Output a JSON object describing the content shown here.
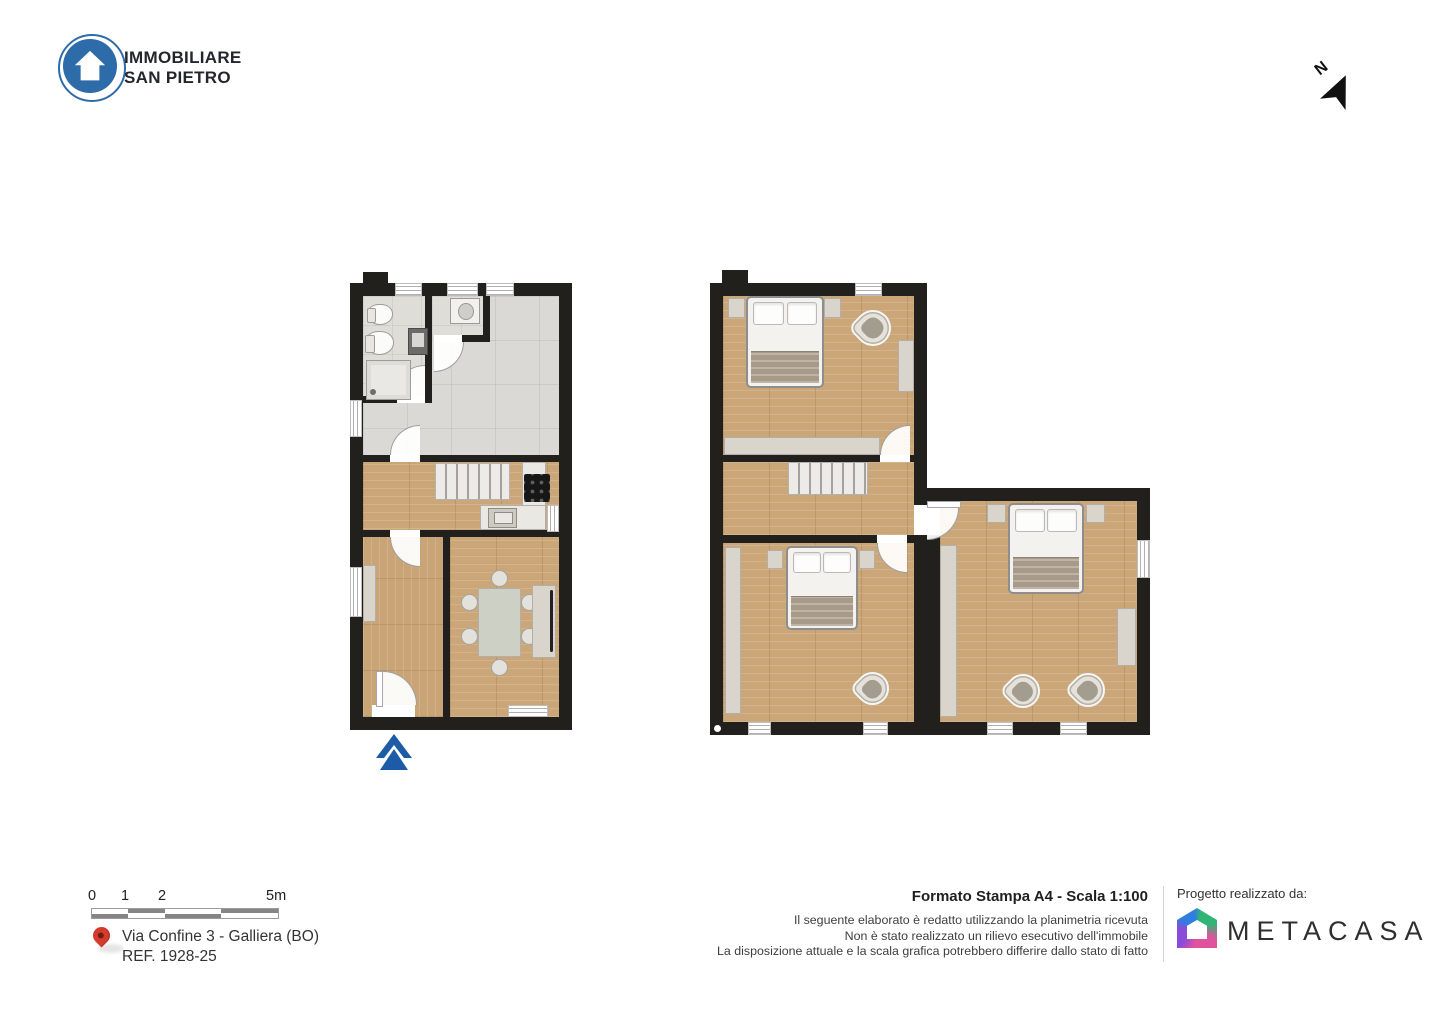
{
  "branding": {
    "agency_line1": "IMMOBILIARE",
    "agency_line2": "SAN PIETRO",
    "logo_color": "#2e6ca9"
  },
  "north": {
    "label": "N"
  },
  "plan": {
    "floors": [
      "ground-floor",
      "first-floor"
    ],
    "entrance_arrow_color": "#1d5ba6"
  },
  "scale_bar": {
    "labels": [
      "0",
      "1",
      "2",
      "5m"
    ]
  },
  "location": {
    "address": "Via Confine 3 - Galliera (BO)",
    "reference": "REF. 1928-25",
    "pin_color": "#d63a2c"
  },
  "print_info": {
    "title": "Formato Stampa A4 - Scala 1:100",
    "disclaimer_lines": [
      "Il seguente elaborato è redatto utilizzando la planimetria ricevuta",
      "Non è stato realizzato un rilievo esecutivo dell'immobile",
      "La disposizione attuale e la scala grafica potrebbero differire dallo stato di fatto"
    ]
  },
  "credits": {
    "label": "Progetto realizzato da:",
    "company": "METACASA"
  }
}
